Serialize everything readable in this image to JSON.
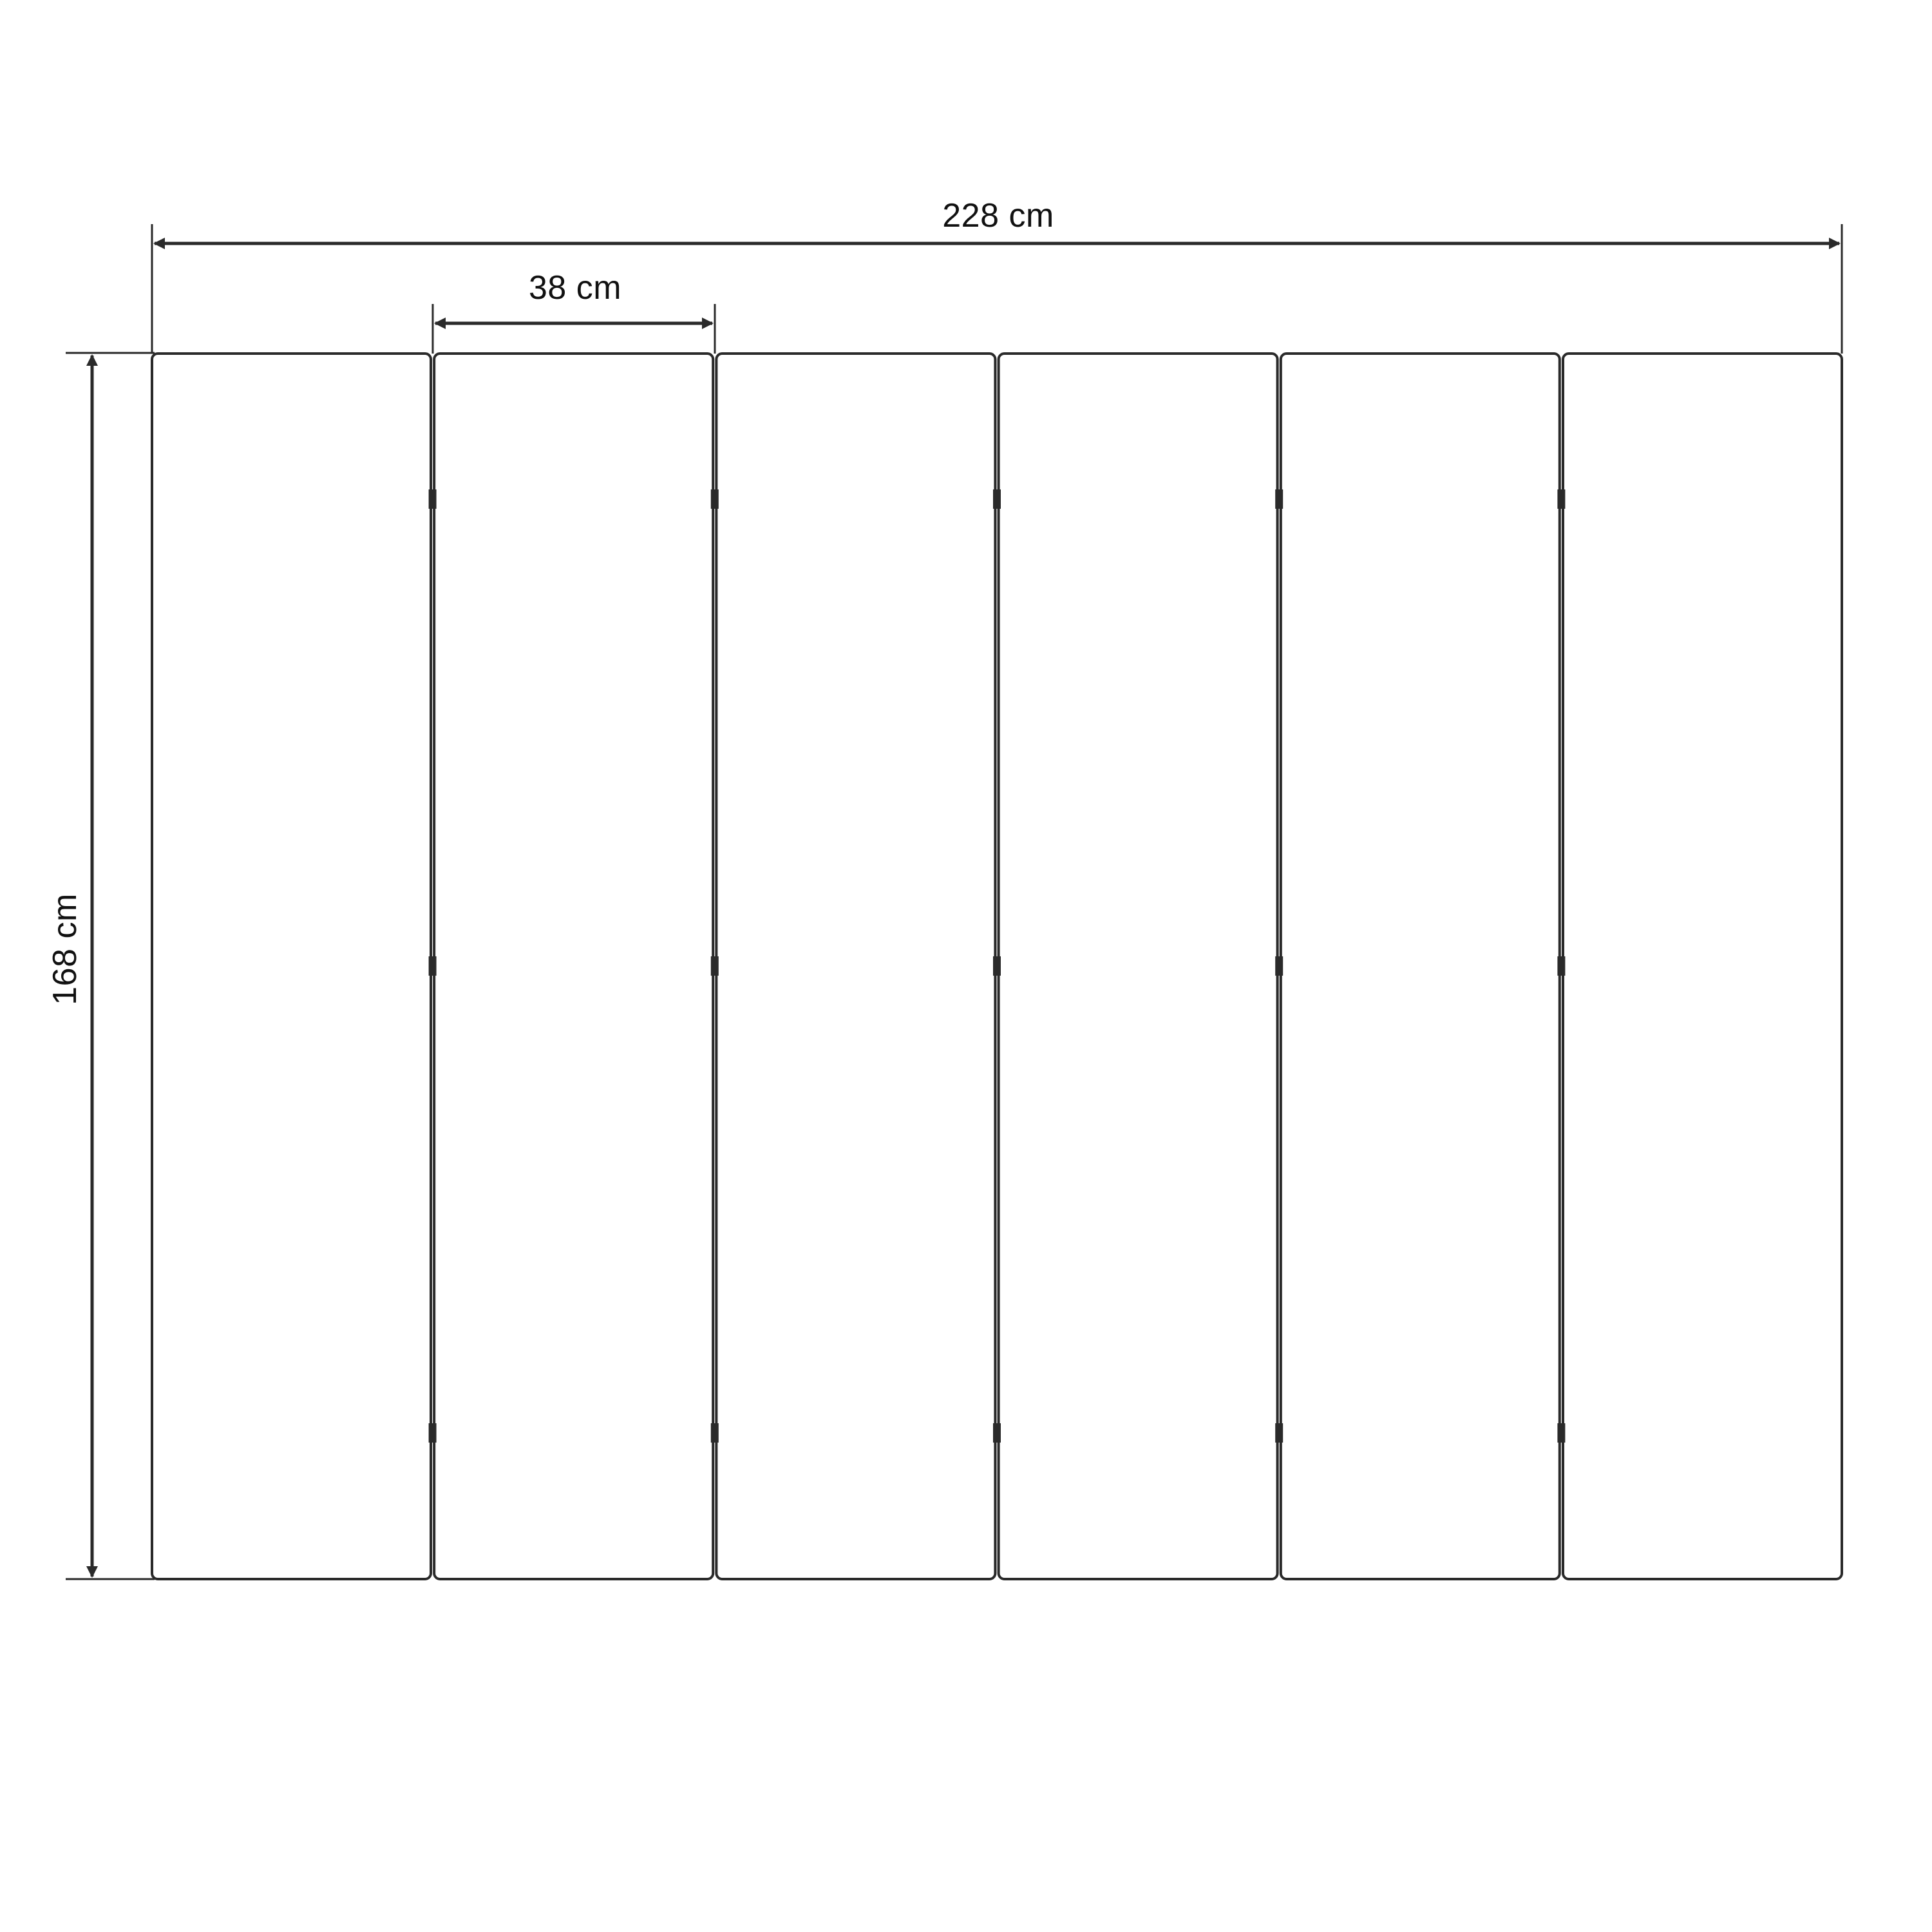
{
  "diagram": {
    "title": "panel-dimension-drawing",
    "panel_count": 6,
    "joint_count": 5,
    "hinge_rows_per_joint": 3,
    "labels": {
      "total_width": "228 cm",
      "panel_width": "38 cm",
      "height": "168 cm"
    },
    "colors": {
      "background": "#ffffff",
      "line": "#2a2a2a",
      "text": "#111111"
    }
  }
}
